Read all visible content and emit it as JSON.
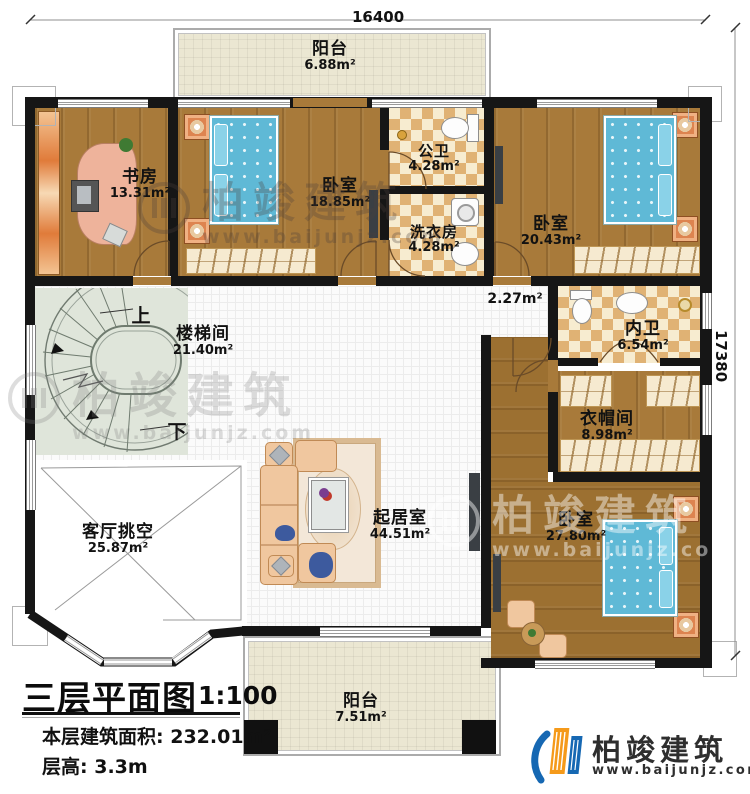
{
  "meta": {
    "plan_title": "三层平面图",
    "scale": "1:100",
    "area_label": "本层建筑面积:",
    "area_value": "232.01m²",
    "floor_height_label": "层高:",
    "floor_height_value": "3.3m"
  },
  "dimensions": {
    "top": "16400",
    "right": "17380"
  },
  "rooms": {
    "balcony_top": {
      "name": "阳台",
      "area": "6.88m²"
    },
    "study": {
      "name": "书房",
      "area": "13.31m²"
    },
    "bedroom1": {
      "name": "卧室",
      "area": "18.85m²"
    },
    "public_bath": {
      "name": "公卫",
      "area": "4.28m²"
    },
    "laundry": {
      "name": "洗衣房",
      "area": "4.28m²"
    },
    "bedroom2": {
      "name": "卧室",
      "area": "20.43m²"
    },
    "stairwell": {
      "name": "楼梯间",
      "area": "21.40m²"
    },
    "corridor": {
      "area": "2.27m²"
    },
    "inner_bath": {
      "name": "内卫",
      "area": "6.54m²"
    },
    "cloakroom": {
      "name": "衣帽间",
      "area": "8.98m²"
    },
    "living_void": {
      "name": "客厅挑空",
      "area": "25.87m²"
    },
    "living_room": {
      "name": "起居室",
      "area": "44.51m²"
    },
    "bedroom3": {
      "name": "卧室",
      "area": "27.80m²"
    },
    "balcony_bottom": {
      "name": "阳台",
      "area": "7.51m²"
    }
  },
  "stairs": {
    "up": "上",
    "down": "下"
  },
  "watermark": {
    "brand": "柏竣建筑",
    "url": "www.baijunjz.com"
  },
  "logo": {
    "brand": "柏竣建筑",
    "url": "www.baijunjz.com"
  },
  "colors": {
    "wall": "#161616",
    "wood": "#a87a3a",
    "balcony_tile": "#ebe7d2",
    "bath_checker": "#e0b274",
    "stair": "#dfe5da",
    "bed": "#5fb9d6",
    "sofa": "#f0c79f",
    "logo_blue": "#1668b3",
    "logo_orange": "#f59a1a"
  }
}
